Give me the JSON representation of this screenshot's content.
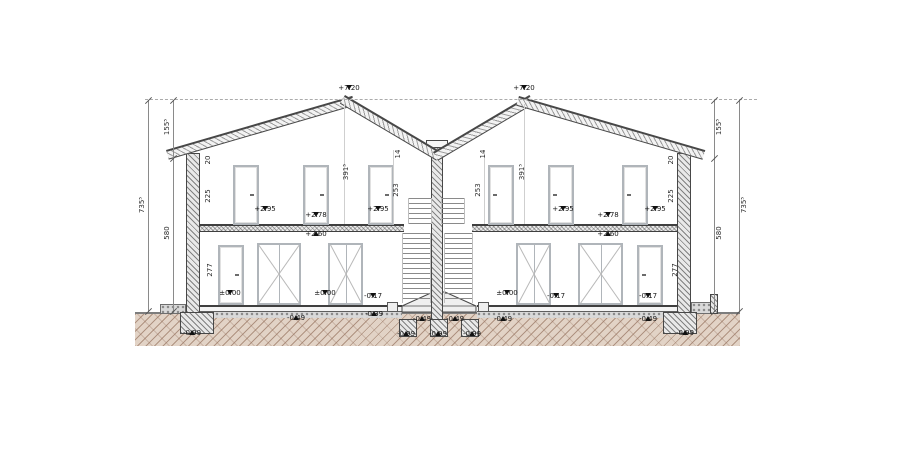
{
  "colors": {
    "ground_fill": "#e2d3c6",
    "ground_hatch": "#94705c",
    "line": "#474747",
    "frame_gray": "#b0b5ba",
    "marker_black": "#101010"
  },
  "level_markers": [
    {
      "value": "+7.20",
      "x": 349,
      "y": 85,
      "dir": "down"
    },
    {
      "value": "+7.20",
      "x": 524,
      "y": 85,
      "dir": "down"
    },
    {
      "value": "+2.95",
      "x": 265,
      "y": 206,
      "dir": "down"
    },
    {
      "value": "+2.78",
      "x": 316,
      "y": 212,
      "dir": "down"
    },
    {
      "value": "+2.95",
      "x": 378,
      "y": 206,
      "dir": "down"
    },
    {
      "value": "+2.60",
      "x": 316,
      "y": 231,
      "dir": "up"
    },
    {
      "value": "+2.95",
      "x": 563,
      "y": 206,
      "dir": "down"
    },
    {
      "value": "+2.78",
      "x": 608,
      "y": 212,
      "dir": "down"
    },
    {
      "value": "+2.95",
      "x": 655,
      "y": 206,
      "dir": "down"
    },
    {
      "value": "+2.60",
      "x": 608,
      "y": 231,
      "dir": "up"
    },
    {
      "value": "±0.00",
      "x": 230,
      "y": 290,
      "dir": "down"
    },
    {
      "value": "±0.00",
      "x": 325,
      "y": 290,
      "dir": "down"
    },
    {
      "value": "-0.17",
      "x": 373,
      "y": 293,
      "dir": "down"
    },
    {
      "value": "±0.00",
      "x": 507,
      "y": 290,
      "dir": "down"
    },
    {
      "value": "-0.17",
      "x": 556,
      "y": 293,
      "dir": "down"
    },
    {
      "value": "-0.17",
      "x": 648,
      "y": 293,
      "dir": "down"
    },
    {
      "value": "-0.39",
      "x": 374,
      "y": 311,
      "dir": "up"
    },
    {
      "value": "-0.49",
      "x": 296,
      "y": 315,
      "dir": "up"
    },
    {
      "value": "-0.49",
      "x": 422,
      "y": 316,
      "dir": "up"
    },
    {
      "value": "-0.49",
      "x": 455,
      "y": 316,
      "dir": "up"
    },
    {
      "value": "-0.49",
      "x": 503,
      "y": 316,
      "dir": "up"
    },
    {
      "value": "-0.49",
      "x": 648,
      "y": 316,
      "dir": "up"
    },
    {
      "value": "-0.99",
      "x": 192,
      "y": 330,
      "dir": "up"
    },
    {
      "value": "-0.99",
      "x": 406,
      "y": 331,
      "dir": "up"
    },
    {
      "value": "-0.99",
      "x": 438,
      "y": 331,
      "dir": "up"
    },
    {
      "value": "-0.99",
      "x": 472,
      "y": 331,
      "dir": "up"
    },
    {
      "value": "-0.99",
      "x": 685,
      "y": 330,
      "dir": "up"
    }
  ],
  "dim_labels": [
    {
      "text": "735⁵",
      "x": 142,
      "y": 205
    },
    {
      "text": "155⁵",
      "x": 167,
      "y": 127
    },
    {
      "text": "580",
      "x": 167,
      "y": 233
    },
    {
      "text": "20",
      "x": 208,
      "y": 160
    },
    {
      "text": "225",
      "x": 208,
      "y": 196
    },
    {
      "text": "277",
      "x": 210,
      "y": 270
    },
    {
      "text": "391⁵",
      "x": 346,
      "y": 172
    },
    {
      "text": "253",
      "x": 396,
      "y": 190
    },
    {
      "text": "14",
      "x": 398,
      "y": 154
    },
    {
      "text": "14",
      "x": 483,
      "y": 154
    },
    {
      "text": "253",
      "x": 478,
      "y": 190
    },
    {
      "text": "391⁵",
      "x": 522,
      "y": 172
    },
    {
      "text": "20",
      "x": 671,
      "y": 160
    },
    {
      "text": "225",
      "x": 671,
      "y": 196
    },
    {
      "text": "277",
      "x": 675,
      "y": 270
    },
    {
      "text": "155⁵",
      "x": 719,
      "y": 127
    },
    {
      "text": "580",
      "x": 719,
      "y": 233
    },
    {
      "text": "735⁵",
      "x": 744,
      "y": 205
    }
  ]
}
